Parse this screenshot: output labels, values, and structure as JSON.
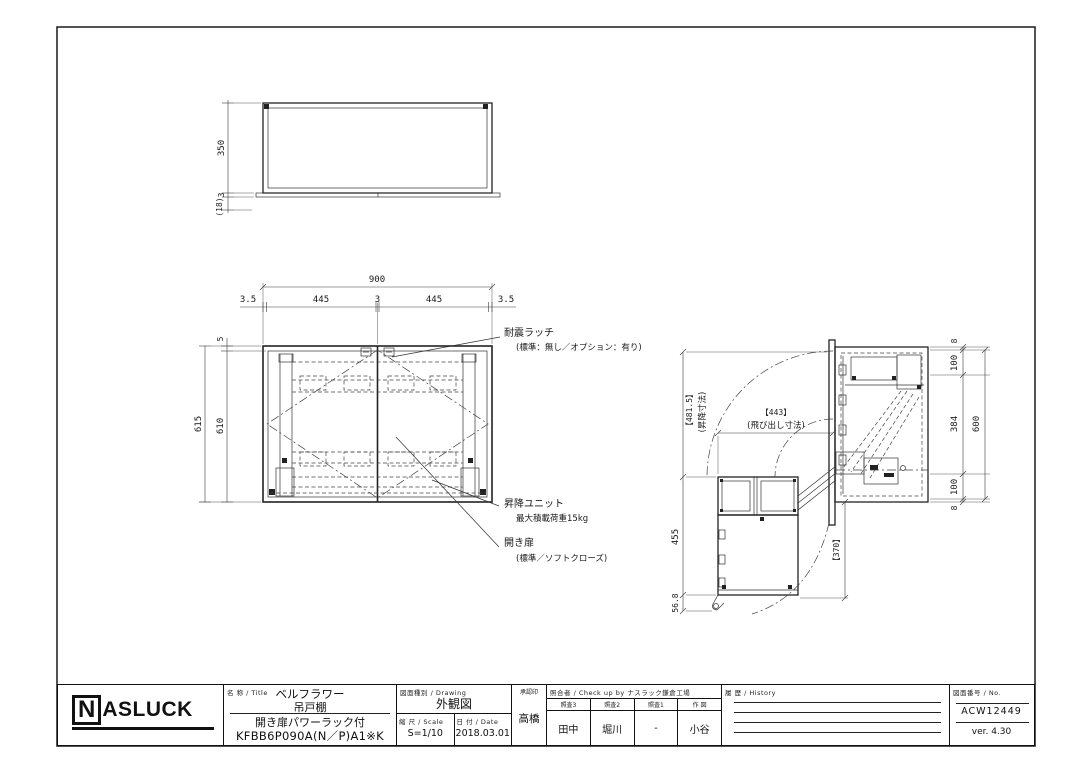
{
  "top_view": {
    "d350": "350",
    "d3": "3",
    "d18": "(18)"
  },
  "front_view": {
    "d900": "900",
    "d35_l": "3.5",
    "d445_l": "445",
    "d3": "3",
    "d445_r": "445",
    "d35_r": "3.5",
    "d5": "5",
    "d615": "615",
    "d610": "610",
    "note_latch": "耐震ラッチ",
    "note_latch_sub": "(標準：無し／オプション：有り)",
    "note_lift": "昇降ユニット",
    "note_lift_sub": "最大積載荷重15kg",
    "note_door": "開き扉",
    "note_door_sub": "(標準／ソフトクローズ)"
  },
  "side_view": {
    "d_lift": "【481.5】",
    "d_lift_sub": "(昇降寸法)",
    "d455": "455",
    "d568": "56.8",
    "d443": "【443】",
    "d443_sub": "(飛び出し寸法)",
    "d370": "【370】",
    "d8_top": "8",
    "d100_top": "100",
    "d384": "384",
    "d100_bot": "100",
    "d8_bot": "8",
    "d600": "600"
  },
  "title_block": {
    "logo_n": "N",
    "logo_rest": "ASLUCK",
    "name_label": "名 称 / Title",
    "product_line1": "ベルフラワー",
    "product_line2": "吊戸棚",
    "product_line3": "開き扉パワーラック付",
    "product_code": "KFBB6P090A(N／P)A1※K",
    "drawing_label": "図面種別 / Drawing",
    "drawing_type": "外観図",
    "scale_label": "縮 尺 / Scale",
    "scale_value": "S=1/10",
    "date_label": "日 付 / Date",
    "date_value": "2018.03.01",
    "approval_label": "承認印",
    "approval_name": "高橋",
    "check_label": "照合者 / Check up by ナスラック鎌倉工場",
    "check_cols": [
      {
        "header": "照査3",
        "name": "田中"
      },
      {
        "header": "照査2",
        "name": "堀川"
      },
      {
        "header": "照査1",
        "name": "-"
      },
      {
        "header": "作 図",
        "name": "小谷"
      }
    ],
    "history_label": "履 歴 / History",
    "no_label": "図面番号 / No.",
    "drawing_no": "ACW12449",
    "version": "ver. 4.30"
  }
}
